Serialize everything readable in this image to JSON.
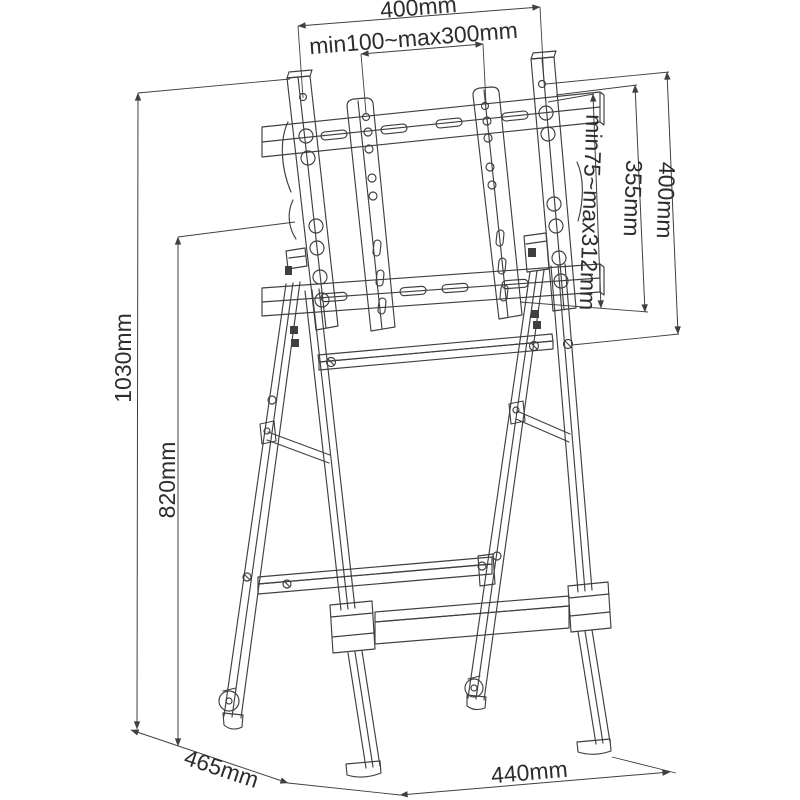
{
  "diagram": {
    "dimensions": {
      "top_width": "400mm",
      "vesa_width_range": "min100~max300mm",
      "bracket_height": "400mm",
      "rail_height": "355mm",
      "vesa_height_range": "min75~max312mm",
      "total_height": "1030mm",
      "frame_height": "820mm",
      "base_depth": "465mm",
      "base_width": "440mm"
    },
    "colors": {
      "line": "#3f3f3f",
      "label": "#2d2d2d",
      "background": "#ffffff"
    }
  }
}
